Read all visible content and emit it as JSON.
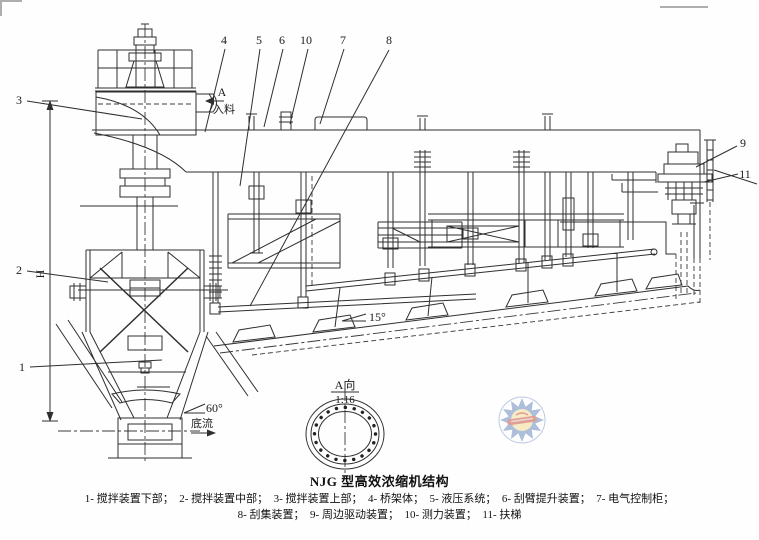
{
  "caption": {
    "title": "NJG 型高效浓缩机结构",
    "line1": "1- 搅拌装置下部；  2- 搅拌装置中部；  3- 搅拌装置上部；  4- 桥架体；  5- 液压系统；  6- 刮臂提升装置；  7- 电气控制柜；",
    "line2": "8- 刮集装置；  9- 周边驱动装置；  10- 测力装置；  11- 扶梯"
  },
  "callouts": {
    "n1": "1",
    "n2": "2",
    "n3": "3",
    "n4": "4",
    "n5": "5",
    "n6": "6",
    "n7": "7",
    "n8": "8",
    "n9": "9",
    "n10": "10",
    "n11": "11"
  },
  "annotations": {
    "view_letter": "A",
    "feed": "入料",
    "detail_title": "A向",
    "detail_scale": "1:16",
    "cone_angle": "60°",
    "underflow": "底流",
    "floor_angle": "15°",
    "height_symbol": "H"
  },
  "colors": {
    "line": "#2f2f2f",
    "scan_frame": "#aeaeae",
    "watermark_blue": "#5d80b6",
    "watermark_yellow": "#f1d98e",
    "watermark_red": "#c04232",
    "background": "#fefefe"
  }
}
